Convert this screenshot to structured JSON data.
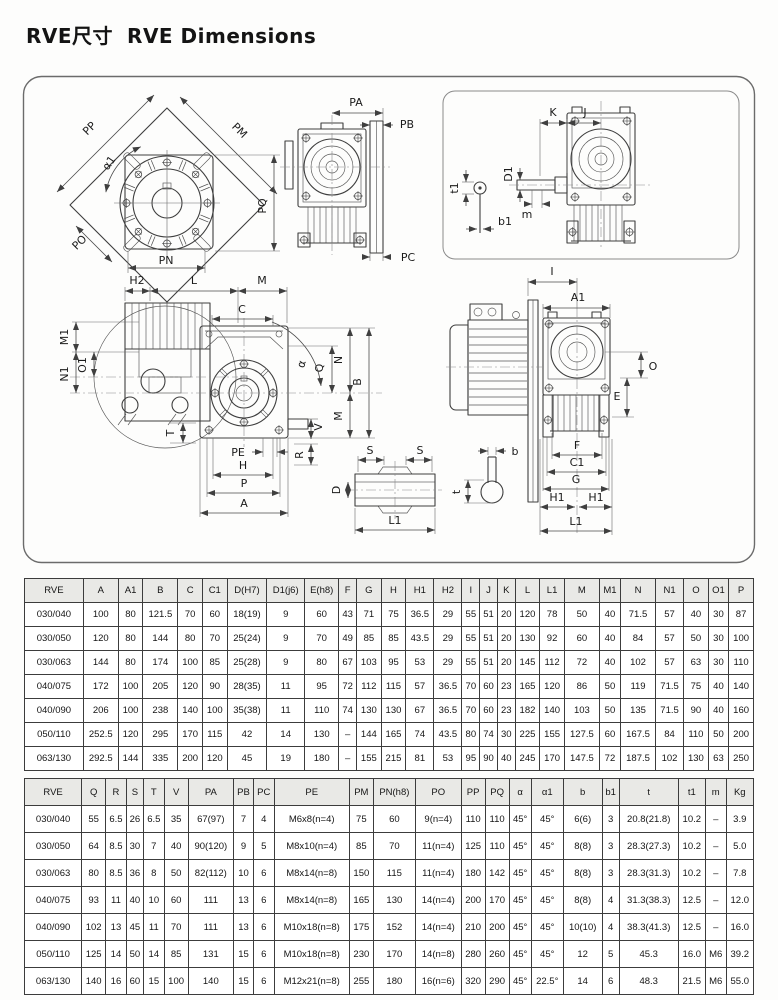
{
  "page": {
    "title_zh": "RVE尺寸",
    "title_en": "RVE Dimensions"
  },
  "drawings": {
    "flange": {
      "pp": "PP",
      "pm": "PM",
      "alpha1": "α1",
      "pq": "PQ",
      "po": "PO",
      "pn": "PN"
    },
    "front": {
      "pa": "PA",
      "pb": "PB",
      "pc": "PC"
    },
    "input": {
      "k": "K",
      "j": "J",
      "t1": "t1",
      "d1": "D1",
      "m": "m",
      "b1": "b1"
    },
    "side": {
      "h2": "H2",
      "l": "L",
      "m_top": "M",
      "c": "C",
      "m1": "M1",
      "o1": "O1",
      "n1": "N1",
      "alpha": "α",
      "q": "Q",
      "n": "N",
      "b": "B",
      "m_right": "M",
      "v": "V",
      "r": "R",
      "pe": "PE",
      "t": "T",
      "h": "H",
      "p": "P",
      "a": "A"
    },
    "motor": {
      "i": "I",
      "a1": "A1",
      "o": "O",
      "e": "E",
      "f": "F",
      "c1": "C1",
      "g": "G",
      "h1_left": "H1",
      "h1_right": "H1",
      "l1": "L1"
    },
    "shaft": {
      "s_left": "S",
      "s_right": "S",
      "d": "D",
      "l1": "L1"
    },
    "keyway": {
      "b": "b",
      "t": "t"
    }
  },
  "table1": {
    "headers": [
      "RVE",
      "A",
      "A1",
      "B",
      "C",
      "C1",
      "D(H7)",
      "D1(j6)",
      "E(h8)",
      "F",
      "G",
      "H",
      "H1",
      "H2",
      "I",
      "J",
      "K",
      "L",
      "L1",
      "M",
      "M1",
      "N",
      "N1",
      "O",
      "O1",
      "P"
    ],
    "rows": [
      [
        "030/040",
        "100",
        "80",
        "121.5",
        "70",
        "60",
        "18(19)",
        "9",
        "60",
        "43",
        "71",
        "75",
        "36.5",
        "29",
        "55",
        "51",
        "20",
        "120",
        "78",
        "50",
        "40",
        "71.5",
        "57",
        "40",
        "30",
        "87"
      ],
      [
        "030/050",
        "120",
        "80",
        "144",
        "80",
        "70",
        "25(24)",
        "9",
        "70",
        "49",
        "85",
        "85",
        "43.5",
        "29",
        "55",
        "51",
        "20",
        "130",
        "92",
        "60",
        "40",
        "84",
        "57",
        "50",
        "30",
        "100"
      ],
      [
        "030/063",
        "144",
        "80",
        "174",
        "100",
        "85",
        "25(28)",
        "9",
        "80",
        "67",
        "103",
        "95",
        "53",
        "29",
        "55",
        "51",
        "20",
        "145",
        "112",
        "72",
        "40",
        "102",
        "57",
        "63",
        "30",
        "110"
      ],
      [
        "040/075",
        "172",
        "100",
        "205",
        "120",
        "90",
        "28(35)",
        "11",
        "95",
        "72",
        "112",
        "115",
        "57",
        "36.5",
        "70",
        "60",
        "23",
        "165",
        "120",
        "86",
        "50",
        "119",
        "71.5",
        "75",
        "40",
        "140"
      ],
      [
        "040/090",
        "206",
        "100",
        "238",
        "140",
        "100",
        "35(38)",
        "11",
        "110",
        "74",
        "130",
        "130",
        "67",
        "36.5",
        "70",
        "60",
        "23",
        "182",
        "140",
        "103",
        "50",
        "135",
        "71.5",
        "90",
        "40",
        "160"
      ],
      [
        "050/110",
        "252.5",
        "120",
        "295",
        "170",
        "115",
        "42",
        "14",
        "130",
        "–",
        "144",
        "165",
        "74",
        "43.5",
        "80",
        "74",
        "30",
        "225",
        "155",
        "127.5",
        "60",
        "167.5",
        "84",
        "110",
        "50",
        "200"
      ],
      [
        "063/130",
        "292.5",
        "144",
        "335",
        "200",
        "120",
        "45",
        "19",
        "180",
        "–",
        "155",
        "215",
        "81",
        "53",
        "95",
        "90",
        "40",
        "245",
        "170",
        "147.5",
        "72",
        "187.5",
        "102",
        "130",
        "63",
        "250"
      ]
    ]
  },
  "table2": {
    "headers": [
      "RVE",
      "Q",
      "R",
      "S",
      "T",
      "V",
      "PA",
      "PB",
      "PC",
      "PE",
      "PM",
      "PN(h8)",
      "PO",
      "PP",
      "PQ",
      "α",
      "α1",
      "b",
      "b1",
      "t",
      "t1",
      "m",
      "Kg"
    ],
    "rows": [
      [
        "030/040",
        "55",
        "6.5",
        "26",
        "6.5",
        "35",
        "67(97)",
        "7",
        "4",
        "M6x8(n=4)",
        "75",
        "60",
        "9(n=4)",
        "110",
        "110",
        "45°",
        "45°",
        "6(6)",
        "3",
        "20.8(21.8)",
        "10.2",
        "–",
        "3.9"
      ],
      [
        "030/050",
        "64",
        "8.5",
        "30",
        "7",
        "40",
        "90(120)",
        "9",
        "5",
        "M8x10(n=4)",
        "85",
        "70",
        "11(n=4)",
        "125",
        "110",
        "45°",
        "45°",
        "8(8)",
        "3",
        "28.3(27.3)",
        "10.2",
        "–",
        "5.0"
      ],
      [
        "030/063",
        "80",
        "8.5",
        "36",
        "8",
        "50",
        "82(112)",
        "10",
        "6",
        "M8x14(n=8)",
        "150",
        "115",
        "11(n=4)",
        "180",
        "142",
        "45°",
        "45°",
        "8(8)",
        "3",
        "28.3(31.3)",
        "10.2",
        "–",
        "7.8"
      ],
      [
        "040/075",
        "93",
        "11",
        "40",
        "10",
        "60",
        "111",
        "13",
        "6",
        "M8x14(n=8)",
        "165",
        "130",
        "14(n=4)",
        "200",
        "170",
        "45°",
        "45°",
        "8(8)",
        "4",
        "31.3(38.3)",
        "12.5",
        "–",
        "12.0"
      ],
      [
        "040/090",
        "102",
        "13",
        "45",
        "11",
        "70",
        "111",
        "13",
        "6",
        "M10x18(n=8)",
        "175",
        "152",
        "14(n=4)",
        "210",
        "200",
        "45°",
        "45°",
        "10(10)",
        "4",
        "38.3(41.3)",
        "12.5",
        "–",
        "16.0"
      ],
      [
        "050/110",
        "125",
        "14",
        "50",
        "14",
        "85",
        "131",
        "15",
        "6",
        "M10x18(n=8)",
        "230",
        "170",
        "14(n=8)",
        "280",
        "260",
        "45°",
        "45°",
        "12",
        "5",
        "45.3",
        "16.0",
        "M6",
        "39.2"
      ],
      [
        "063/130",
        "140",
        "16",
        "60",
        "15",
        "100",
        "140",
        "15",
        "6",
        "M12x21(n=8)",
        "255",
        "180",
        "16(n=6)",
        "320",
        "290",
        "45°",
        "22.5°",
        "14",
        "6",
        "48.3",
        "21.5",
        "M6",
        "55.0"
      ]
    ]
  }
}
